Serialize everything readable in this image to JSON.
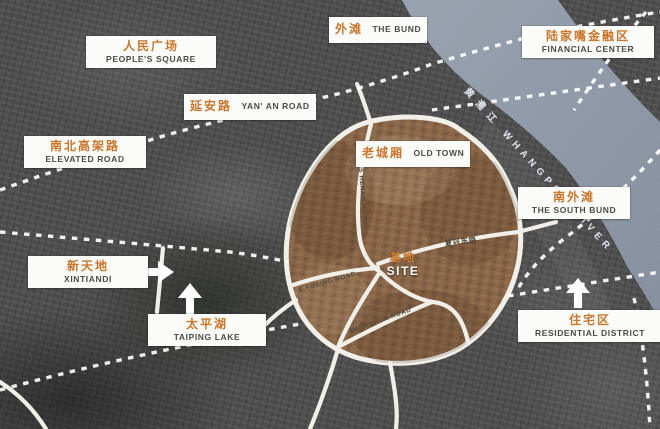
{
  "map_title": "Shanghai Old Town site location map",
  "labels": [
    {
      "id": "peoples-square",
      "zh": "人民广场",
      "en": "PEOPLE'S SQUARE"
    },
    {
      "id": "the-bund",
      "zh": "外滩",
      "en": "THE BUND"
    },
    {
      "id": "financial-center",
      "zh": "陆家嘴金融区",
      "en": "FINANCIAL CENTER"
    },
    {
      "id": "yanan-road",
      "zh": "延安路",
      "en": "YAN' AN ROAD"
    },
    {
      "id": "elevated-road",
      "zh": "南北高架路",
      "en": "ELEVATED ROAD"
    },
    {
      "id": "old-town",
      "zh": "老城厢",
      "en": "OLD TOWN"
    },
    {
      "id": "south-bund",
      "zh": "南外滩",
      "en": "THE SOUTH BUND"
    },
    {
      "id": "xintiandi",
      "zh": "新天地",
      "en": "XINTIANDI"
    },
    {
      "id": "taiping-lake",
      "zh": "太平湖",
      "en": "TAIPING LAKE"
    },
    {
      "id": "residential-district",
      "zh": "住宅区",
      "en": "RESIDENTIAL DISTRICT"
    }
  ],
  "site": {
    "zh": "基地",
    "en": "SITE"
  },
  "river": {
    "zh": "黄浦江",
    "en": "WHANGPOO RIVER"
  },
  "road_names": [
    "S HENAN ROAD",
    "E FUXING ROAD",
    "复兴东路",
    "ZHONGHUA ROAD"
  ],
  "icons": [
    "xintiandi-right-arrow",
    "taiping-lake-up-arrow",
    "residential-up-arrow"
  ],
  "colors": {
    "accent_orange": "#c8762b",
    "label_english_text": "#4c4a45",
    "label_box": "#fbfbfa",
    "river_water": "#8e99a6",
    "old_town_fill": "#8b6547",
    "road_white": "#f2efe9",
    "land_gray": "#4d4d4d"
  }
}
